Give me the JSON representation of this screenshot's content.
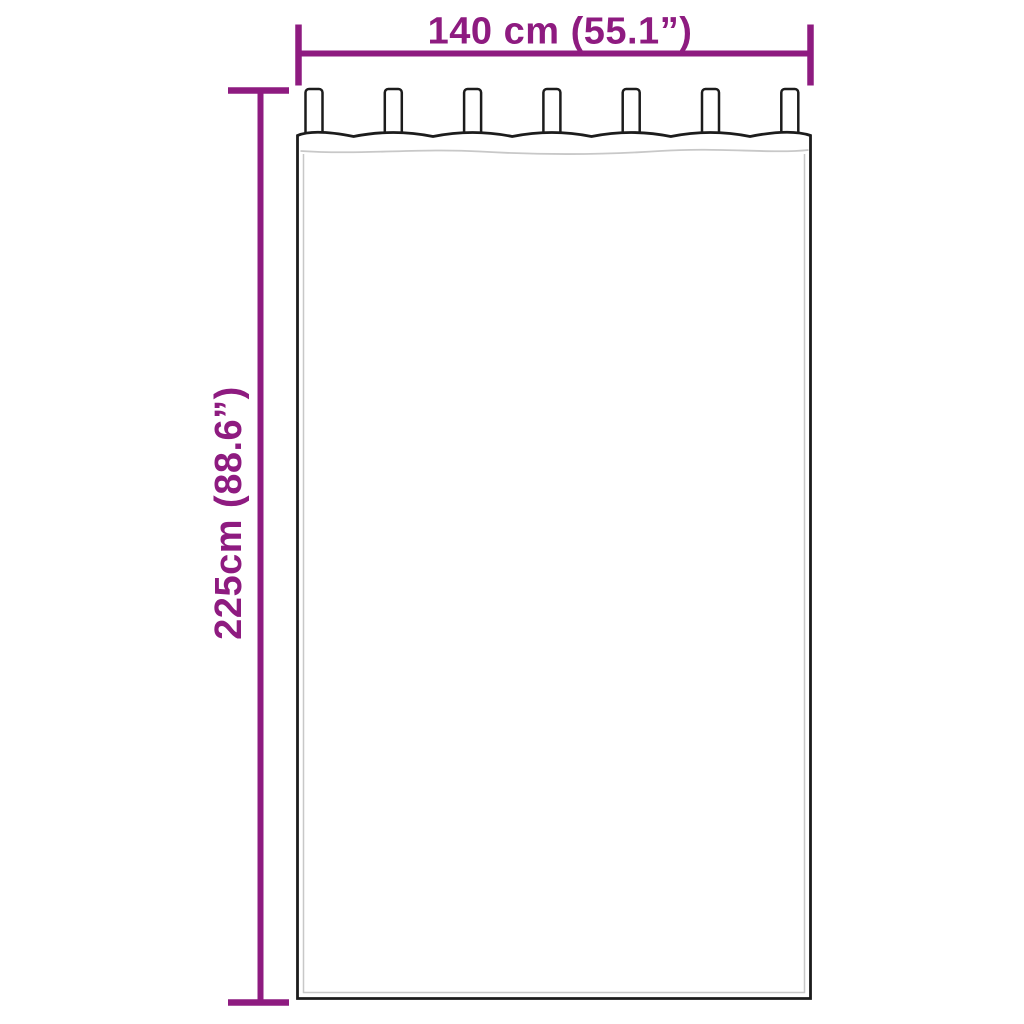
{
  "diagram": {
    "subject": "tab-top curtain dimension drawing",
    "width_label": "140 cm (55.1”)",
    "height_label": "225cm (88.6”)",
    "tab_count": 7,
    "colors": {
      "dimension": "#8E1B80",
      "outline": "#1C1C1C",
      "seam": "#C8C8C8",
      "background": "#FFFFFF"
    }
  }
}
